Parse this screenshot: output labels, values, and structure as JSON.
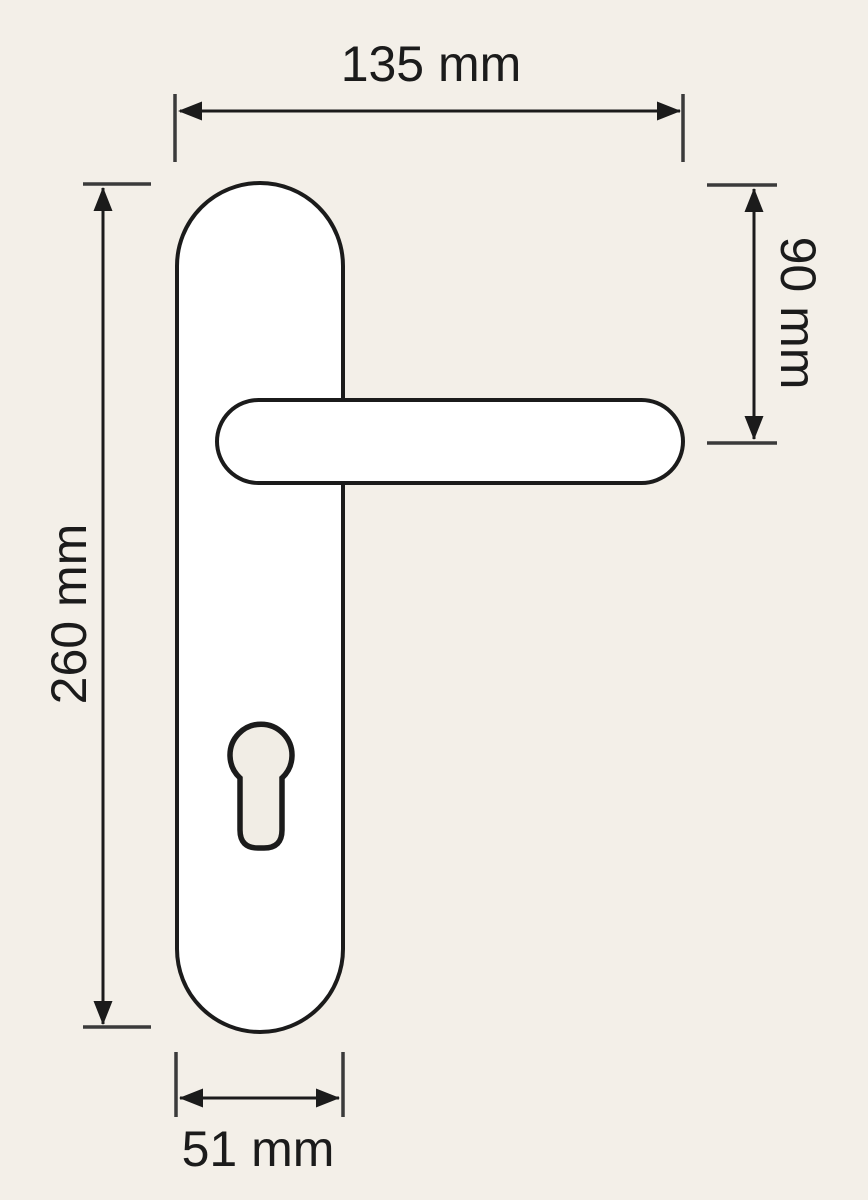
{
  "figure": {
    "shapes": [
      "backplate",
      "lever-handle",
      "euro-cylinder-keyhole"
    ]
  },
  "dimensions": {
    "overall_width": {
      "label": "135 mm",
      "value": 135,
      "unit": "mm"
    },
    "handle_axis_from_top": {
      "label": "90 mm",
      "value": 90,
      "unit": "mm"
    },
    "plate_length": {
      "label": "260 mm",
      "value": 260,
      "unit": "mm"
    },
    "plate_width": {
      "label": "51 mm",
      "value": 51,
      "unit": "mm"
    }
  },
  "colors": {
    "bg": "#f3efe8",
    "ink": "#1b1b1b",
    "dim": "#3a3a3a",
    "shape_fill": "#ffffff",
    "cutout_fill": "#f1ede5"
  }
}
